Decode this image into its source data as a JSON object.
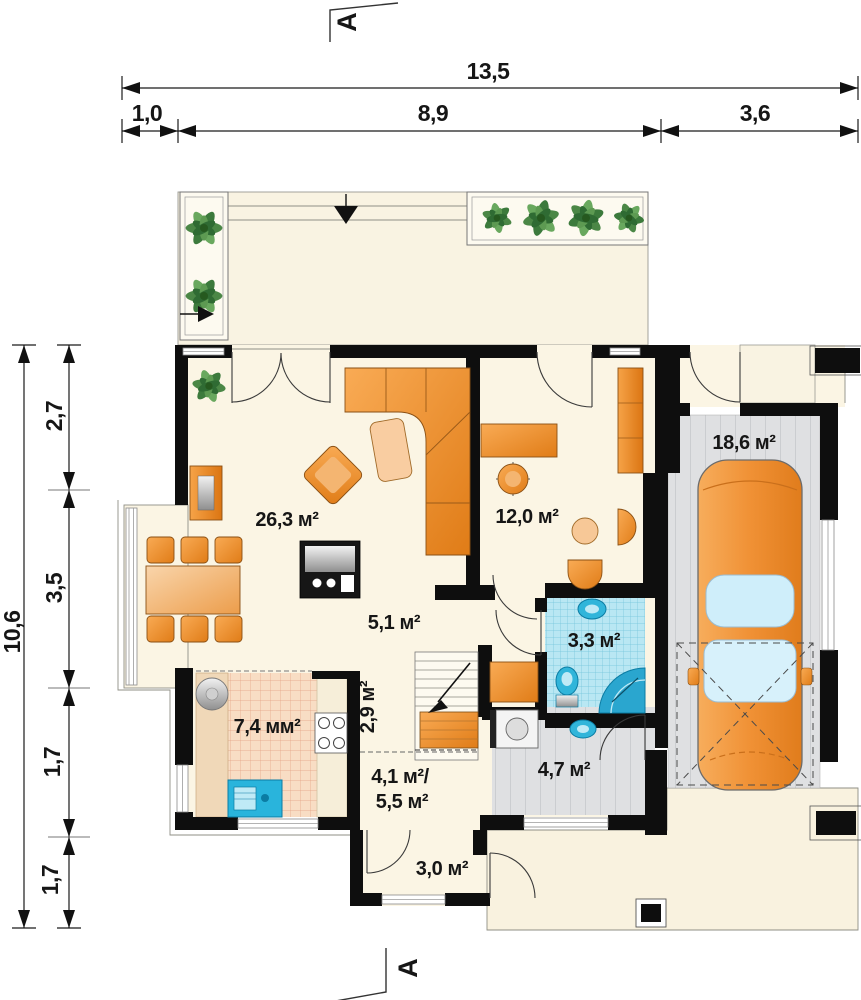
{
  "drawing": {
    "type": "floor-plan",
    "section_markers": {
      "top": "A",
      "bottom": "A"
    }
  },
  "dimensions_top": {
    "total": "13,5",
    "segments": [
      {
        "label": "1,0"
      },
      {
        "label": "8,9"
      },
      {
        "label": "3,6"
      }
    ]
  },
  "dimensions_left": {
    "total": "10,6",
    "segments": [
      {
        "label": "2,7"
      },
      {
        "label": "3,5"
      },
      {
        "label": "1,7"
      },
      {
        "label": "1,7"
      }
    ]
  },
  "rooms": {
    "living": "26,3 м²",
    "study": "12,0 м²",
    "garage": "18,6 м²",
    "hall_small": "5,1 м²",
    "bathroom": "3,3 м²",
    "kitchen": "7,4 мм²",
    "pantry": "2,9 м²",
    "hallway_line1": "4,1 м²/",
    "hallway_line2": "5,5 м²",
    "utility": "4,7 м²",
    "vestibule": "3,0 м²"
  },
  "colors": {
    "wall": "#0e0e0e",
    "room_cream": "#fbf5e4",
    "terrace_beige": "#f9f2df",
    "furniture_orange": "#ef8b28",
    "bath_tile": "#b9e7f3",
    "kitchen_tile": "#f8ddc4",
    "garage_floor": "#dfe0e2",
    "fixture_blue": "#31b5da",
    "plant_green": "#4b8746"
  }
}
